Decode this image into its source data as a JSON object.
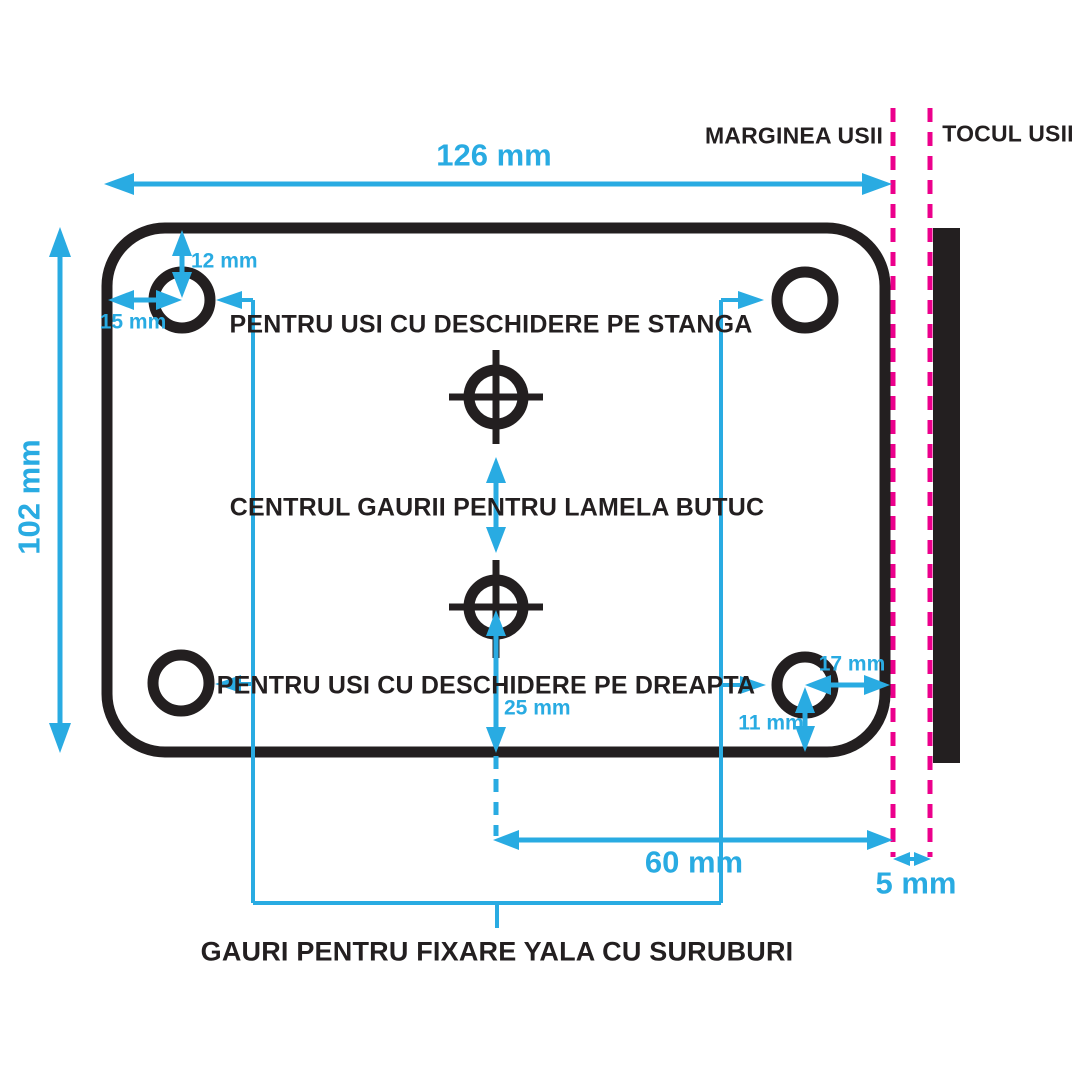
{
  "labels": {
    "marginea_usii": "MARGINEA USII",
    "tocul_usii": "TOCUL USII",
    "deschidere_stanga": "PENTRU USI CU DESCHIDERE PE STANGA",
    "centrul_gaurii": "CENTRUL GAURII PENTRU LAMELA BUTUC",
    "deschidere_dreapta": "PENTRU USI CU DESCHIDERE PE DREAPTA",
    "gauri_fixare": "GAURI PENTRU FIXARE YALA CU SURUBURI"
  },
  "dimensions": {
    "plate_width": "126 mm",
    "plate_height": "102 mm",
    "top_hole_from_top": "12 mm",
    "top_hole_from_left": "15 mm",
    "cylinder_hole_from_bottom": "25 mm",
    "cylinder_hole_from_door_edge": "60 mm",
    "bottom_hole_from_door_edge": "17 mm",
    "bottom_hole_from_bottom": "11 mm",
    "door_edge_to_frame": "5 mm"
  },
  "colors": {
    "dimension_cyan": "#29ABE2",
    "door_edge_magenta": "#EC008C",
    "ink_black": "#231F20"
  }
}
